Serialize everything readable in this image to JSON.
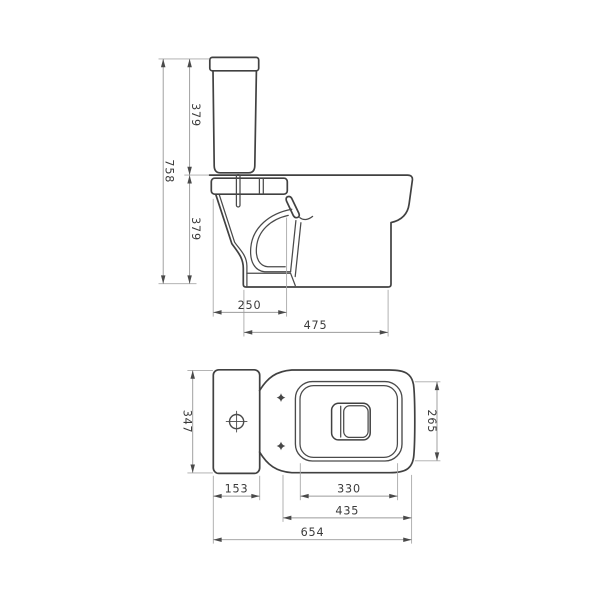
{
  "drawing": {
    "subject": "close-coupled toilet two-view dimensional drawing",
    "colors": {
      "background": "#ffffff",
      "outline": "#414141",
      "dimension_lines": "#9b9b9b",
      "text": "#3b3b3b"
    }
  },
  "side_view": {
    "dims": {
      "overall_height": "758",
      "cistern_height": "379",
      "pan_height": "379",
      "front_projection": "250",
      "base_depth": "475"
    }
  },
  "plan_view": {
    "dims": {
      "cistern_width": "347",
      "cistern_depth": "153",
      "seat_opening_length": "330",
      "pan_length": "435",
      "overall_length": "654",
      "pan_width": "265"
    }
  }
}
